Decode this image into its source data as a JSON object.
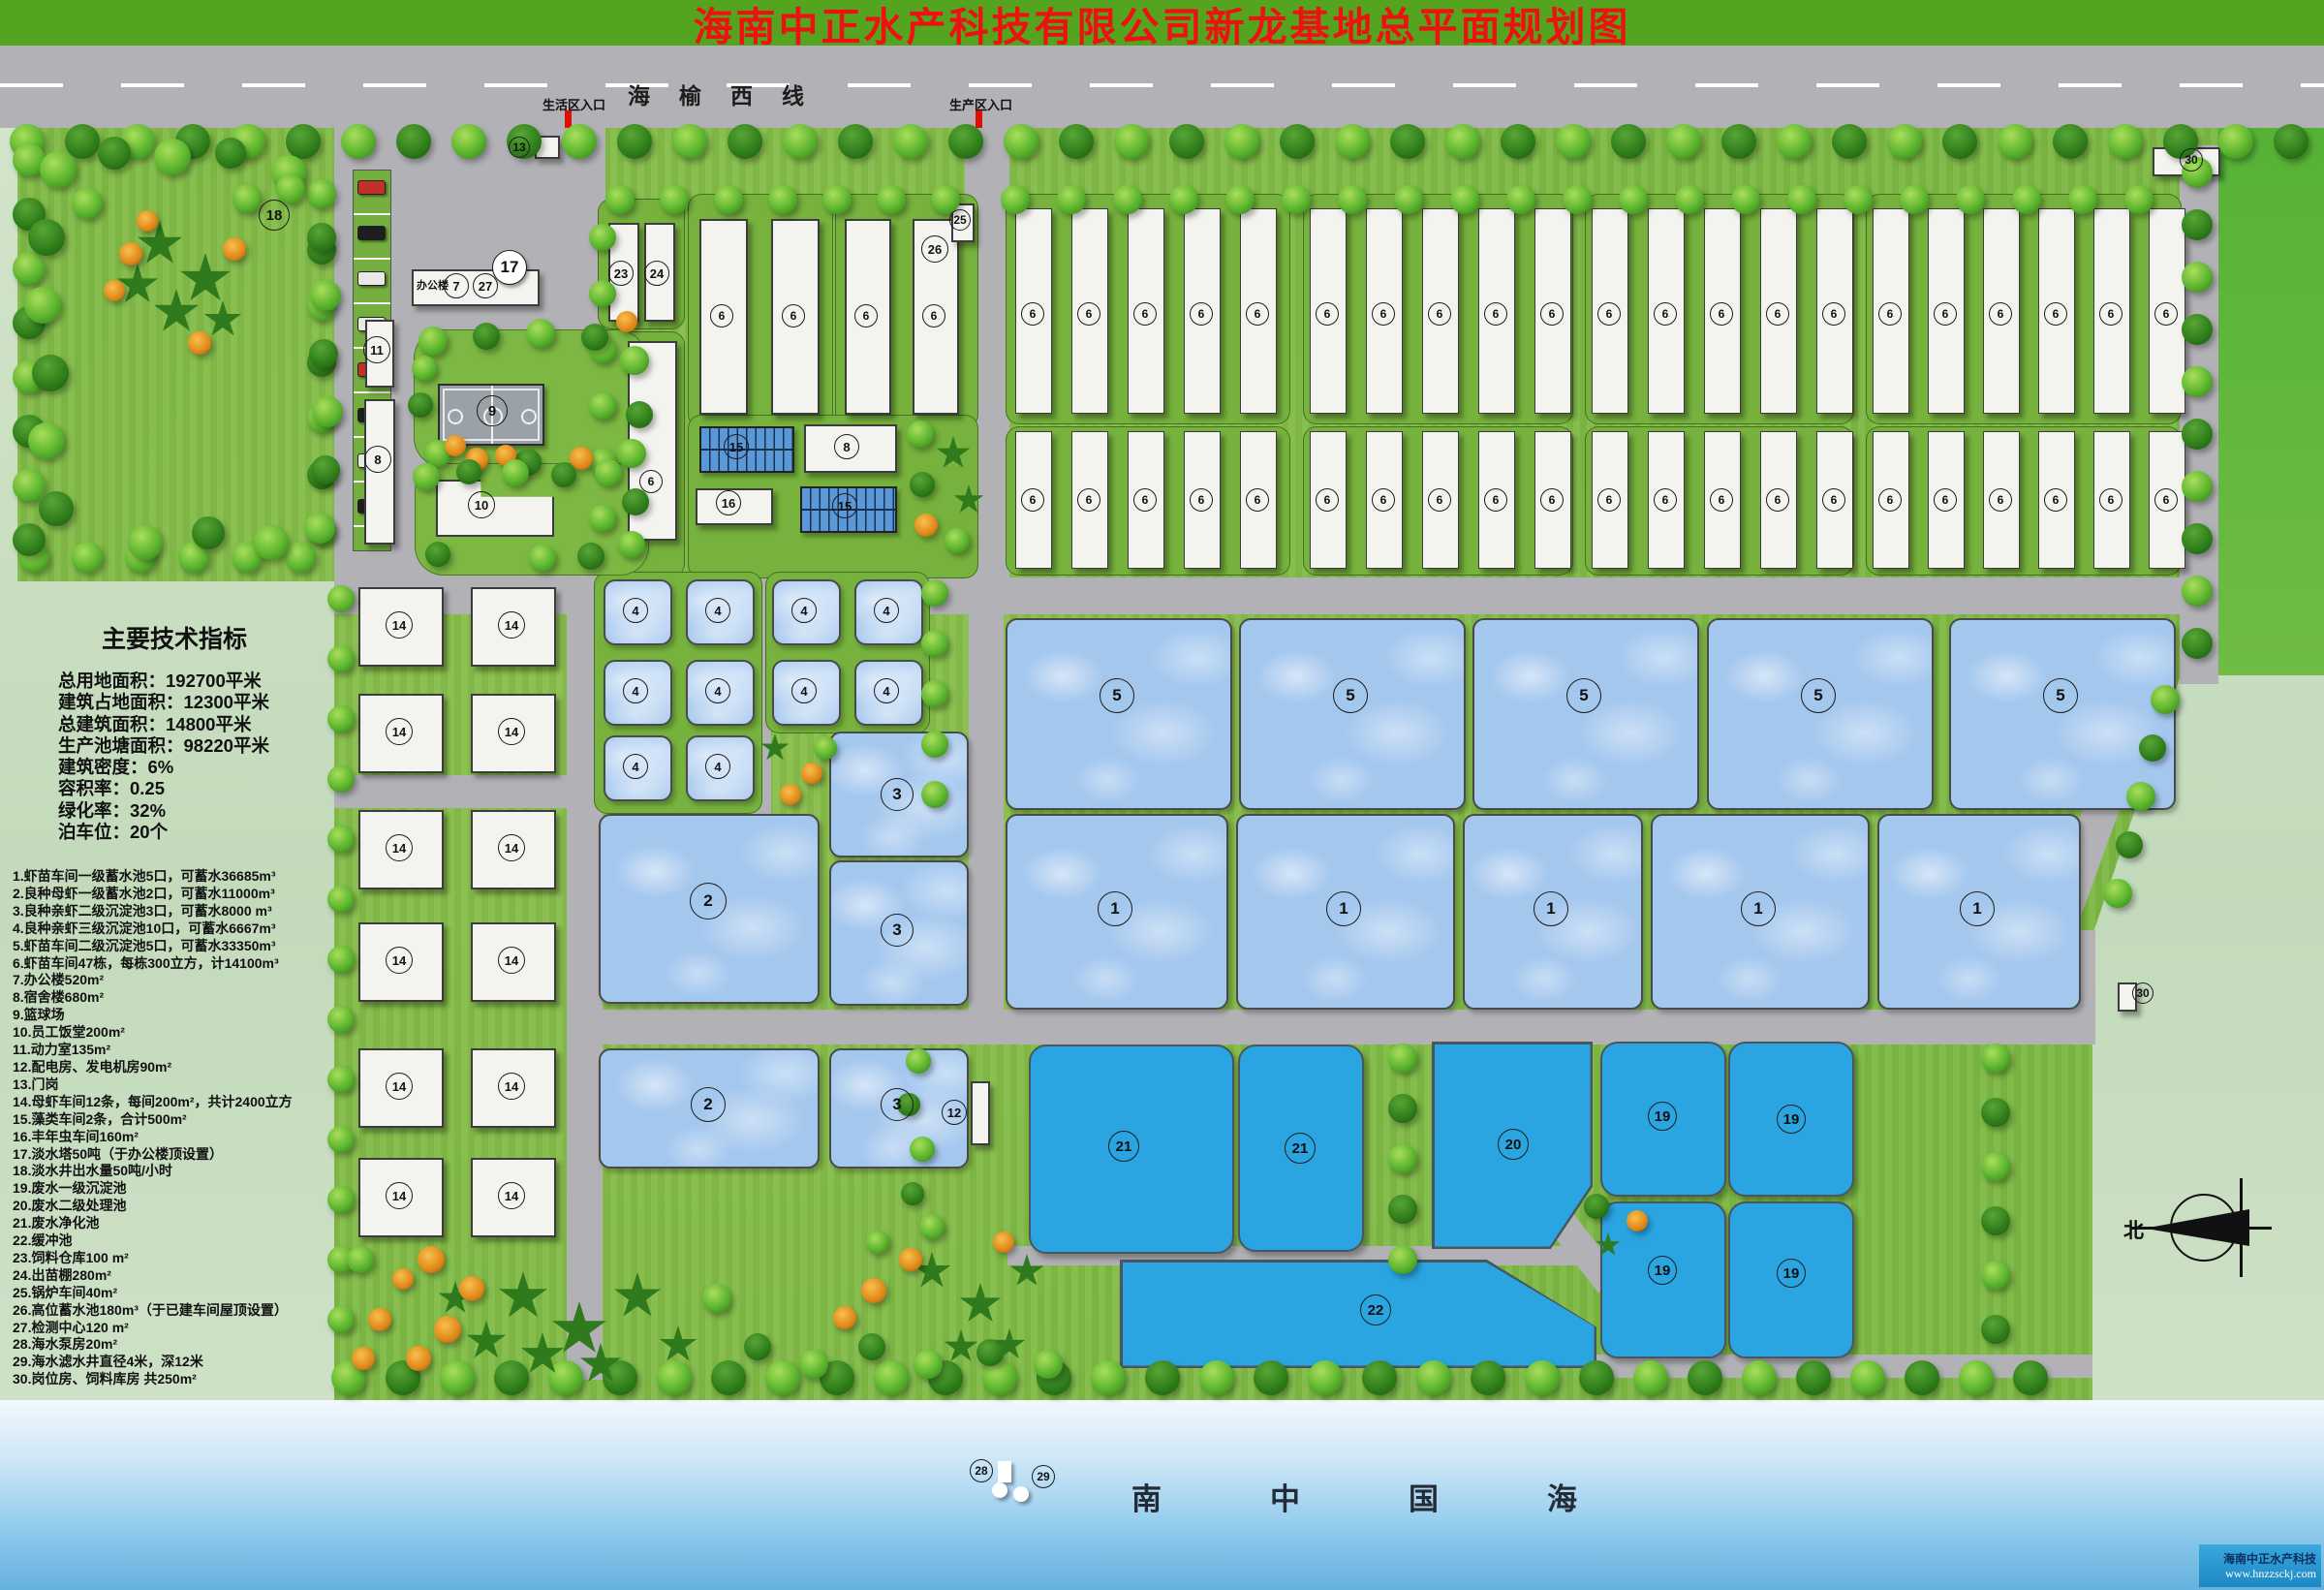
{
  "title": "海南中正水产科技有限公司新龙基地总平面规划图",
  "road": {
    "name": "海榆西线",
    "entrance_left": "生活区入口",
    "entrance_right": "生产区入口"
  },
  "tech": {
    "title": "主要技术指标",
    "lines": [
      "总用地面积：192700平米",
      "建筑占地面积：12300平米",
      "总建筑面积：14800平米",
      "生产池塘面积：98220平米",
      "建筑密度：6%",
      "容积率：0.25",
      "绿化率：32%",
      "泊车位：20个"
    ]
  },
  "legend": [
    "1.虾苗车间一级蓄水池5口，可蓄水36685m³",
    "2.良种母虾一级蓄水池2口，可蓄水11000m³",
    "3.良种亲虾二级沉淀池3口，可蓄水8000 m³",
    "4.良种亲虾三级沉淀池10口，可蓄水6667m³",
    "5.虾苗车间二级沉淀池5口，可蓄水33350m³",
    "6.虾苗车间47栋，每栋300立方，计14100m³",
    "7.办公楼520m²",
    "8.宿舍楼680m²",
    "9.篮球场",
    "10.员工饭堂200m²",
    "11.动力室135m²",
    "12.配电房、发电机房90m²",
    "13.门岗",
    "14.母虾车间12条，每间200m²，共计2400立方",
    "15.藻类车间2条，合计500m²",
    "16.丰年虫车间160m²",
    "17.淡水塔50吨（于办公楼顶设置）",
    "18.淡水井出水量50吨/小时",
    "19.废水一级沉淀池",
    "20.废水二级处理池",
    "21.废水净化池",
    "22.缓冲池",
    "23.饲料仓库100 m²",
    "24.出苗棚280m²",
    "25.锅炉车间40m²",
    "26.高位蓄水池180m³（于已建车间屋顶设置）",
    "27.检测中心120 m²",
    "28.海水泵房20m²",
    "29.海水滤水井直径4米，深12米",
    "30.岗位房、饲料库房 共250m²"
  ],
  "sea_label": "南中国海",
  "compass_label": "北",
  "watermark": {
    "line1": "海南中正水产科技",
    "line2": "www.hnzzsckj.com"
  },
  "colors": {
    "title_bar": "#55a41f",
    "title_text": "#ee1111",
    "road": "#b2b2b6",
    "site_green": "#7cb843",
    "pond_light": "#a4c7ee",
    "pond_cyan": "#2aa5e1",
    "sea_top": "#f2f9fd",
    "sea_bottom": "#64b1de",
    "logo_bg": "#2b9fd9"
  },
  "map": {
    "office_label": "办公楼",
    "strip_label": "6",
    "markers": [
      [
        "18",
        283,
        222,
        30
      ],
      [
        "13",
        536,
        152,
        20
      ],
      [
        "17",
        526,
        276,
        34,
        "w"
      ],
      [
        "7",
        471,
        295,
        24
      ],
      [
        "27",
        501,
        295,
        24
      ],
      [
        "9",
        508,
        424,
        30
      ],
      [
        "11",
        389,
        361,
        26
      ],
      [
        "8",
        390,
        474,
        26
      ],
      [
        "10",
        497,
        521,
        26
      ],
      [
        "23",
        641,
        282,
        24
      ],
      [
        "24",
        678,
        282,
        24
      ],
      [
        "6",
        745,
        326,
        22
      ],
      [
        "6",
        819,
        326,
        22
      ],
      [
        "6",
        894,
        326,
        22
      ],
      [
        "6",
        964,
        326,
        22
      ],
      [
        "6",
        672,
        497,
        22
      ],
      [
        "25",
        991,
        227,
        20
      ],
      [
        "26",
        965,
        257,
        26
      ],
      [
        "15",
        760,
        461,
        24
      ],
      [
        "8",
        874,
        461,
        24
      ],
      [
        "16",
        752,
        519,
        24
      ],
      [
        "15",
        872,
        522,
        24
      ],
      [
        "4",
        656,
        630,
        24
      ],
      [
        "4",
        741,
        630,
        24
      ],
      [
        "4",
        830,
        630,
        24
      ],
      [
        "4",
        915,
        630,
        24
      ],
      [
        "4",
        656,
        713,
        24
      ],
      [
        "4",
        741,
        713,
        24
      ],
      [
        "4",
        830,
        713,
        24
      ],
      [
        "4",
        915,
        713,
        24
      ],
      [
        "4",
        656,
        791,
        24
      ],
      [
        "4",
        741,
        791,
        24
      ],
      [
        "5",
        1153,
        718,
        34
      ],
      [
        "5",
        1394,
        718,
        34
      ],
      [
        "5",
        1635,
        718,
        34
      ],
      [
        "5",
        1877,
        718,
        34
      ],
      [
        "5",
        2127,
        718,
        34
      ],
      [
        "1",
        1151,
        938,
        34
      ],
      [
        "1",
        1387,
        938,
        34
      ],
      [
        "1",
        1601,
        938,
        34
      ],
      [
        "1",
        1815,
        938,
        34
      ],
      [
        "1",
        2041,
        938,
        34
      ],
      [
        "2",
        731,
        930,
        36
      ],
      [
        "3",
        926,
        820,
        32
      ],
      [
        "3",
        926,
        960,
        32
      ],
      [
        "2",
        731,
        1140,
        34
      ],
      [
        "3",
        926,
        1140,
        32
      ],
      [
        "12",
        985,
        1148,
        24
      ],
      [
        "21",
        1160,
        1183,
        30
      ],
      [
        "21",
        1342,
        1185,
        30
      ],
      [
        "20",
        1562,
        1181,
        30
      ],
      [
        "19",
        1716,
        1152,
        28
      ],
      [
        "19",
        1849,
        1155,
        28
      ],
      [
        "19",
        1716,
        1311,
        28
      ],
      [
        "19",
        1849,
        1314,
        28
      ],
      [
        "22",
        1420,
        1352,
        30
      ],
      [
        "14",
        412,
        645,
        26
      ],
      [
        "14",
        528,
        645,
        26
      ],
      [
        "14",
        412,
        755,
        26
      ],
      [
        "14",
        528,
        755,
        26
      ],
      [
        "14",
        412,
        875,
        26
      ],
      [
        "14",
        528,
        875,
        26
      ],
      [
        "14",
        412,
        991,
        26
      ],
      [
        "14",
        528,
        991,
        26
      ],
      [
        "14",
        412,
        1121,
        26
      ],
      [
        "14",
        528,
        1121,
        26
      ],
      [
        "14",
        412,
        1234,
        26
      ],
      [
        "14",
        528,
        1234,
        26
      ],
      [
        "28",
        1013,
        1518,
        22
      ],
      [
        "29",
        1077,
        1524,
        22
      ],
      [
        "30",
        2262,
        165,
        22
      ],
      [
        "30",
        2212,
        1025,
        20
      ]
    ]
  }
}
